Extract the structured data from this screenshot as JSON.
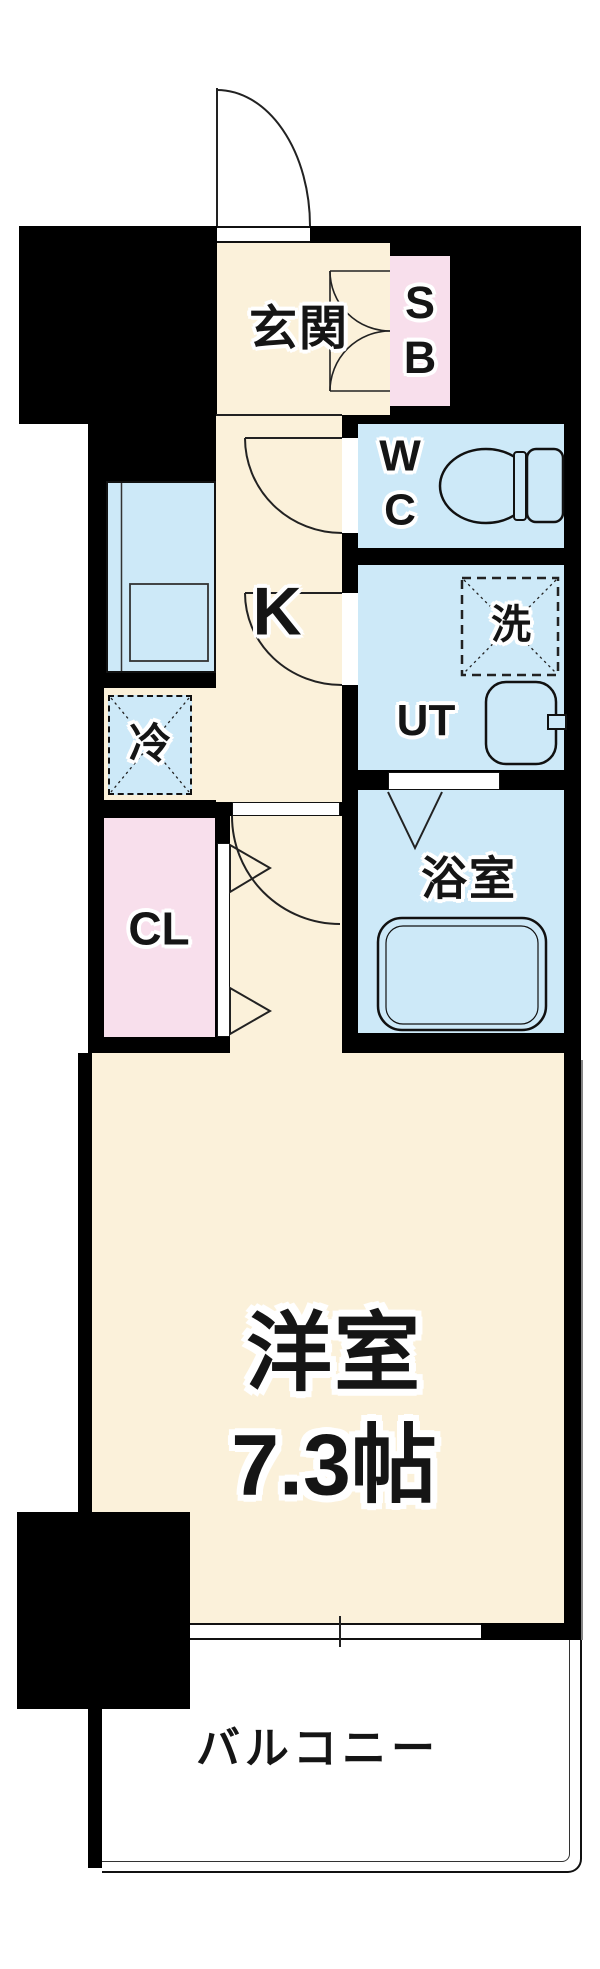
{
  "rooms": {
    "genkan": {
      "label": "玄関"
    },
    "shoe_box": {
      "line1": "S",
      "line2": "B"
    },
    "toilet": {
      "line1": "W",
      "line2": "C"
    },
    "kitchen": {
      "label": "K"
    },
    "washer": {
      "label": "洗"
    },
    "utility": {
      "label": "UT"
    },
    "fridge": {
      "label": "冷"
    },
    "closet": {
      "label": "CL"
    },
    "bath": {
      "label": "浴室"
    },
    "main_room": {
      "name": "洋室",
      "size": "7.3帖"
    },
    "balcony": {
      "label": "バルコニー"
    }
  },
  "colors": {
    "floor_cream": "#FBF1DA",
    "room_blue": "#CDE9F8",
    "closet_pink": "#F8DFEC",
    "wall_black": "#000000"
  }
}
